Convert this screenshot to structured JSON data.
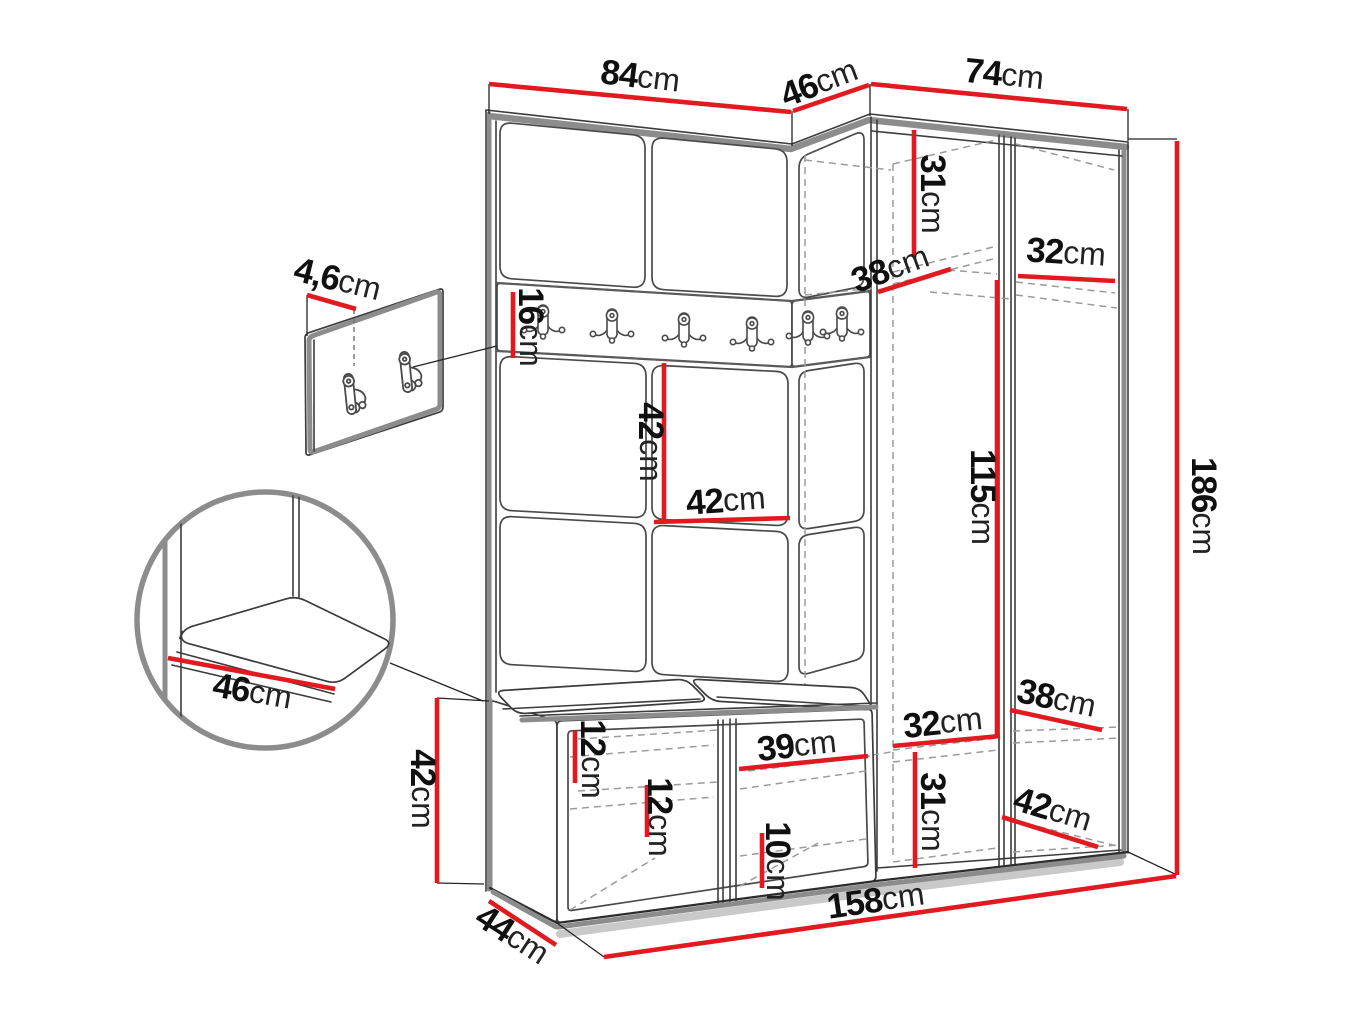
{
  "figure": {
    "kind": "furniture-dimension-diagram",
    "subject": "hallway-set-with-coat-rack-corner-wardrobe-and-shoe-bench",
    "measurement_unit": "cm"
  },
  "colors": {
    "dimension_red": "#e2191f",
    "line_dark": "#3c3c3c",
    "edge_gray": "#8c8c8c",
    "hidden_dash": "#9b9b9b",
    "background": "#ffffff"
  },
  "dimensions": [
    {
      "id": "top-width-left",
      "value": "84",
      "unit": "cm",
      "x": 640,
      "y": 79,
      "rot": 7,
      "line": [
        489,
        84,
        791,
        112
      ],
      "ext": [
        [
          489,
          84,
          489,
          114
        ],
        [
          792,
          111,
          792,
          146
        ]
      ]
    },
    {
      "id": "top-width-corner",
      "value": "46",
      "unit": "cm",
      "x": 820,
      "y": 85,
      "rot": -21,
      "line": [
        793,
        111,
        869,
        85
      ],
      "ext": [
        [
          870,
          84,
          870,
          116
        ]
      ]
    },
    {
      "id": "top-width-right",
      "value": "74",
      "unit": "cm",
      "x": 1004,
      "y": 77,
      "rot": 6,
      "line": [
        871,
        84,
        1127,
        109
      ],
      "ext": [
        [
          1128,
          109,
          1128,
          141
        ]
      ]
    },
    {
      "id": "panel-thickness",
      "value": "4,6",
      "unit": "cm",
      "x": 337,
      "y": 282,
      "rot": 14,
      "line": [
        307,
        295,
        356,
        309
      ],
      "ext": [
        [
          307,
          295,
          307,
          336
        ]
      ]
    },
    {
      "id": "rail-height",
      "value": "16",
      "unit": "cm",
      "x": 528,
      "y": 327,
      "rot": 90,
      "line": [
        513,
        292,
        513,
        358
      ],
      "ext": []
    },
    {
      "id": "top-shelf-height",
      "value": "31",
      "unit": "cm",
      "x": 930,
      "y": 194,
      "rot": 90,
      "line": [
        914,
        130,
        914,
        257
      ],
      "ext": []
    },
    {
      "id": "corner-shelf-depth",
      "value": "38",
      "unit": "cm",
      "x": 891,
      "y": 271,
      "rot": -20,
      "line": [
        878,
        292,
        951,
        269
      ],
      "ext": []
    },
    {
      "id": "top-shelf-width",
      "value": "32",
      "unit": "cm",
      "x": 1066,
      "y": 255,
      "rot": 4,
      "line": [
        1018,
        276,
        1115,
        281
      ],
      "ext": []
    },
    {
      "id": "wall-panel-height",
      "value": "42",
      "unit": "cm",
      "x": 648,
      "y": 442,
      "rot": 90,
      "line": [
        664,
        363,
        664,
        520
      ],
      "ext": []
    },
    {
      "id": "wall-panel-width",
      "value": "42",
      "unit": "cm",
      "x": 726,
      "y": 503,
      "rot": -4,
      "line": [
        654,
        522,
        790,
        518
      ],
      "ext": []
    },
    {
      "id": "hanging-height",
      "value": "115",
      "unit": "cm",
      "x": 980,
      "y": 497,
      "rot": 90,
      "line": [
        997,
        280,
        997,
        735
      ],
      "ext": []
    },
    {
      "id": "total-height",
      "value": "186",
      "unit": "cm",
      "x": 1201,
      "y": 506,
      "rot": 90,
      "line": [
        1177,
        141,
        1177,
        875
      ],
      "ext": [
        [
          1128,
          139,
          1177,
          139
        ],
        [
          1128,
          852,
          1177,
          875
        ]
      ]
    },
    {
      "id": "seat-depth-detail",
      "value": "46",
      "unit": "cm",
      "x": 252,
      "y": 694,
      "rot": 10,
      "line": [
        168,
        658,
        335,
        689
      ],
      "ext": []
    },
    {
      "id": "bench-height",
      "value": "42",
      "unit": "cm",
      "x": 420,
      "y": 789,
      "rot": 90,
      "line": [
        437,
        698,
        437,
        883
      ],
      "ext": [
        [
          437,
          698,
          489,
          701
        ],
        [
          437,
          883,
          484,
          884
        ]
      ]
    },
    {
      "id": "bench-depth",
      "value": "44",
      "unit": "cm",
      "x": 511,
      "y": 937,
      "rot": 33,
      "line": [
        489,
        901,
        556,
        945
      ],
      "ext": []
    },
    {
      "id": "shoe-shelf-gap-1",
      "value": "12",
      "unit": "cm",
      "x": 590,
      "y": 759,
      "rot": 90,
      "line": [
        575,
        731,
        575,
        783
      ],
      "ext": []
    },
    {
      "id": "shoe-shelf-gap-2",
      "value": "12",
      "unit": "cm",
      "x": 657,
      "y": 817,
      "rot": 90,
      "line": [
        647,
        785,
        647,
        837
      ],
      "ext": []
    },
    {
      "id": "compartment-width",
      "value": "39",
      "unit": "cm",
      "x": 797,
      "y": 748,
      "rot": -6,
      "line": [
        739,
        769,
        868,
        756
      ],
      "ext": []
    },
    {
      "id": "bottom-gap-height",
      "value": "10",
      "unit": "cm",
      "x": 775,
      "y": 861,
      "rot": 90,
      "line": [
        762,
        833,
        762,
        888
      ],
      "ext": []
    },
    {
      "id": "bottom-shelf-width",
      "value": "32",
      "unit": "cm",
      "x": 943,
      "y": 725,
      "rot": -6,
      "line": [
        893,
        746,
        1000,
        736
      ],
      "ext": []
    },
    {
      "id": "bottom-section-height",
      "value": "31",
      "unit": "cm",
      "x": 930,
      "y": 812,
      "rot": 90,
      "line": [
        915,
        752,
        915,
        868
      ],
      "ext": []
    },
    {
      "id": "bottom-shelf-depth",
      "value": "38",
      "unit": "cm",
      "x": 1056,
      "y": 701,
      "rot": 12,
      "line": [
        1010,
        710,
        1102,
        730
      ],
      "ext": []
    },
    {
      "id": "floor-depth",
      "value": "42",
      "unit": "cm",
      "x": 1052,
      "y": 812,
      "rot": 17,
      "line": [
        1002,
        817,
        1098,
        847
      ],
      "ext": []
    },
    {
      "id": "total-width",
      "value": "158",
      "unit": "cm",
      "x": 876,
      "y": 903,
      "rot": -8,
      "line": [
        604,
        957,
        1176,
        876
      ],
      "ext": [
        [
          557,
          923,
          604,
          957
        ]
      ]
    }
  ],
  "hardware": {
    "rail_hooks": [
      [
        543,
        322
      ],
      [
        612,
        326
      ],
      [
        684,
        330
      ],
      [
        752,
        334
      ],
      [
        808,
        328
      ],
      [
        842,
        324
      ]
    ],
    "panel_hooks": [
      [
        350,
        394
      ],
      [
        406,
        372
      ]
    ]
  }
}
